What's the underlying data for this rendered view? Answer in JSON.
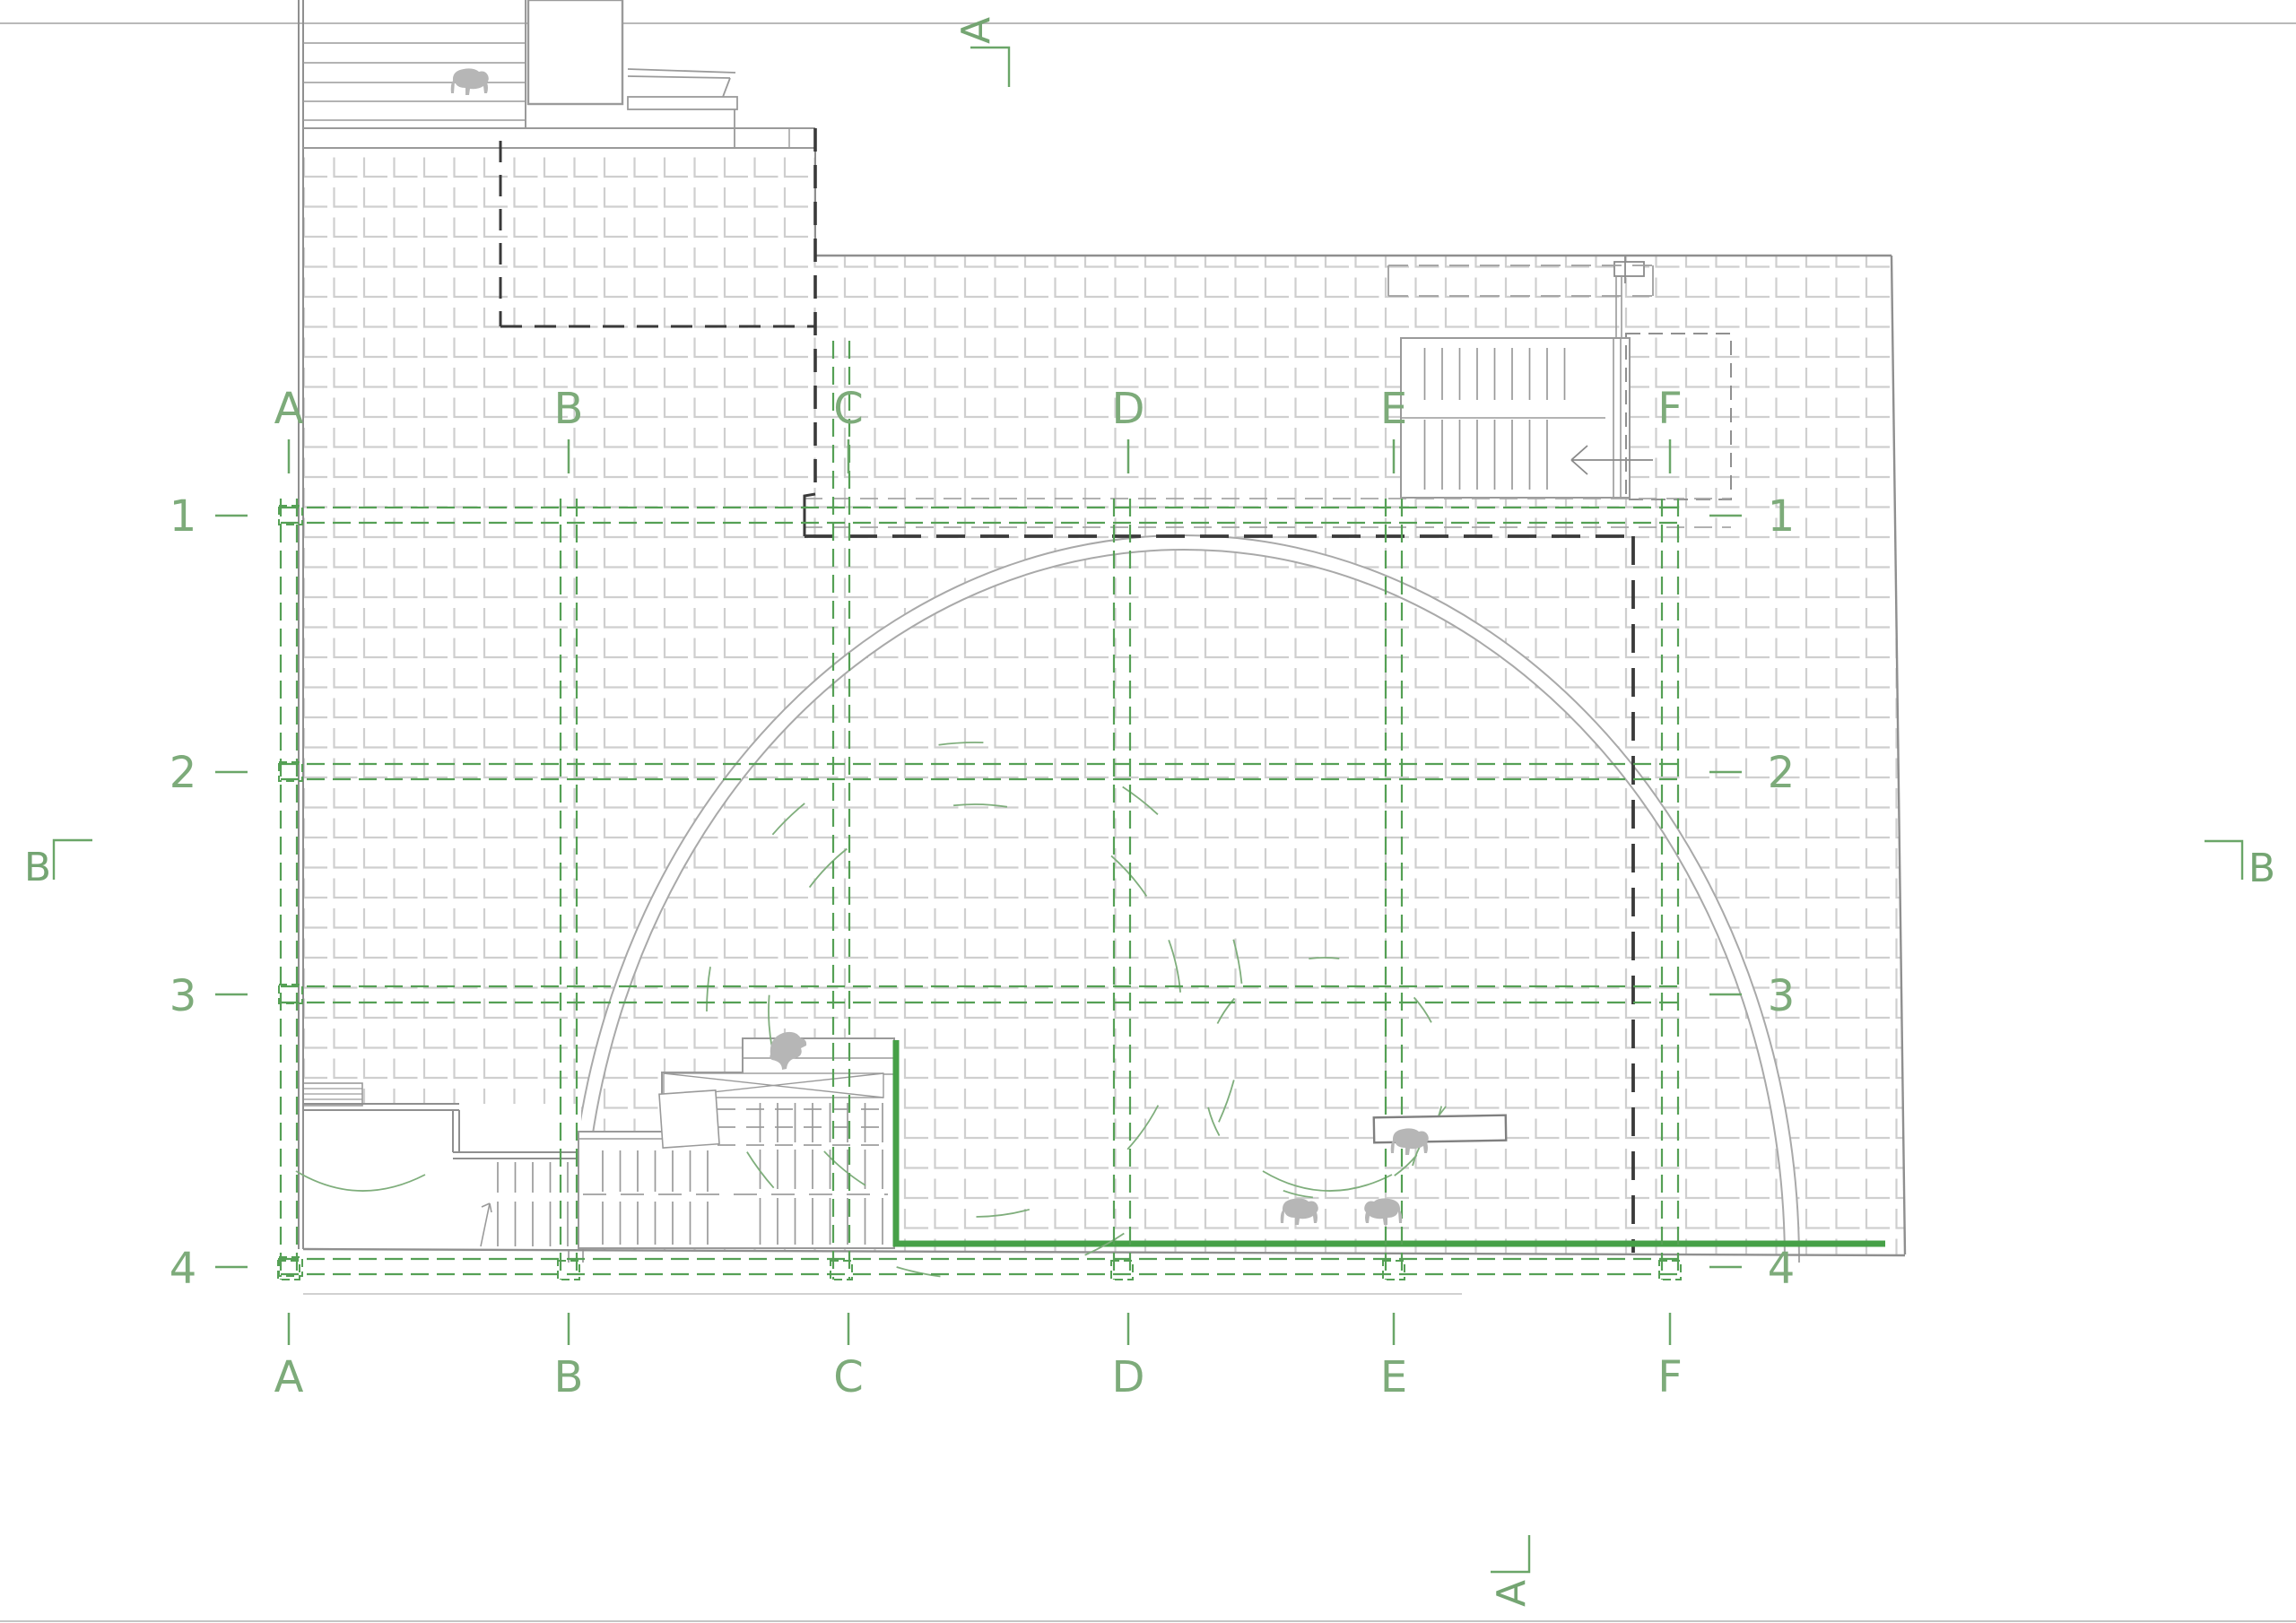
{
  "drawing": {
    "kind": "architectural roof plan with structural grid",
    "colors": {
      "accent_green_strong": "#46a047",
      "grid_green": "#55a055",
      "label_green": "#7dab7a",
      "building_gray": "#9a9a9a",
      "hatch_gray": "#cfcfcf",
      "heavy_dash_black": "#333333",
      "animal_gray": "#b6b6b6"
    },
    "grid": {
      "column_labels": [
        "A",
        "B",
        "C",
        "D",
        "E",
        "F"
      ],
      "row_labels": [
        "1",
        "2",
        "3",
        "4"
      ]
    },
    "section_markers": {
      "top": "A",
      "bottom": "A",
      "left": "B",
      "right": "B"
    }
  }
}
